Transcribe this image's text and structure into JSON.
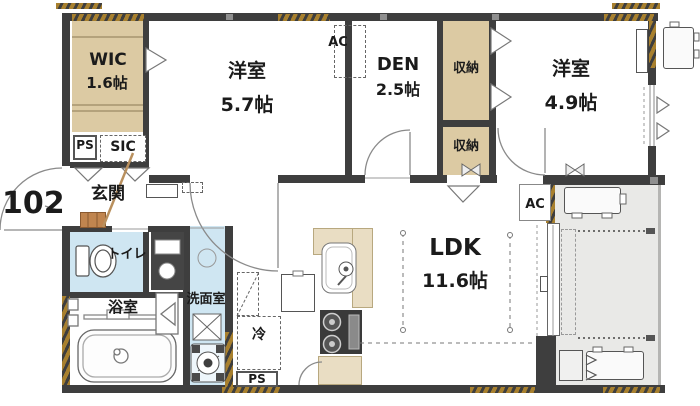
{
  "floorplan": {
    "unit_number": "102",
    "rooms": {
      "wic": {
        "name": "WIC",
        "size": "1.6帖"
      },
      "bedroom_57": {
        "name": "洋室",
        "size": "5.7帖"
      },
      "den": {
        "name": "DEN",
        "size": "2.5帖"
      },
      "storage_upper": {
        "name": "収納"
      },
      "storage_lower": {
        "name": "収納"
      },
      "bedroom_49": {
        "name": "洋室",
        "size": "4.9帖"
      },
      "ldk": {
        "name": "LDK",
        "size": "11.6帖"
      },
      "entrance": {
        "name": "玄関"
      },
      "toilet": {
        "name": "トイレ"
      },
      "bathroom": {
        "name": "浴室"
      },
      "washroom": {
        "name": "洗面室"
      }
    },
    "labels": {
      "ac_bedroom": "AC",
      "ac_ldk": "AC",
      "pipe_space_upper": "PS",
      "pipe_space_lower": "PS",
      "shoe_closet": "SIC",
      "refrigerator": "冷"
    },
    "colors": {
      "wall": "#3e3e3e",
      "closet_fill": "#dccaa3",
      "kitchen_counter_fill": "#e9ddc3",
      "wet_area_fill": "#cfe6f2",
      "balcony_fill": "#e9e9e7",
      "insulation_hatch": "#a8802e",
      "entrance_step_wood": "#c0854f"
    }
  }
}
